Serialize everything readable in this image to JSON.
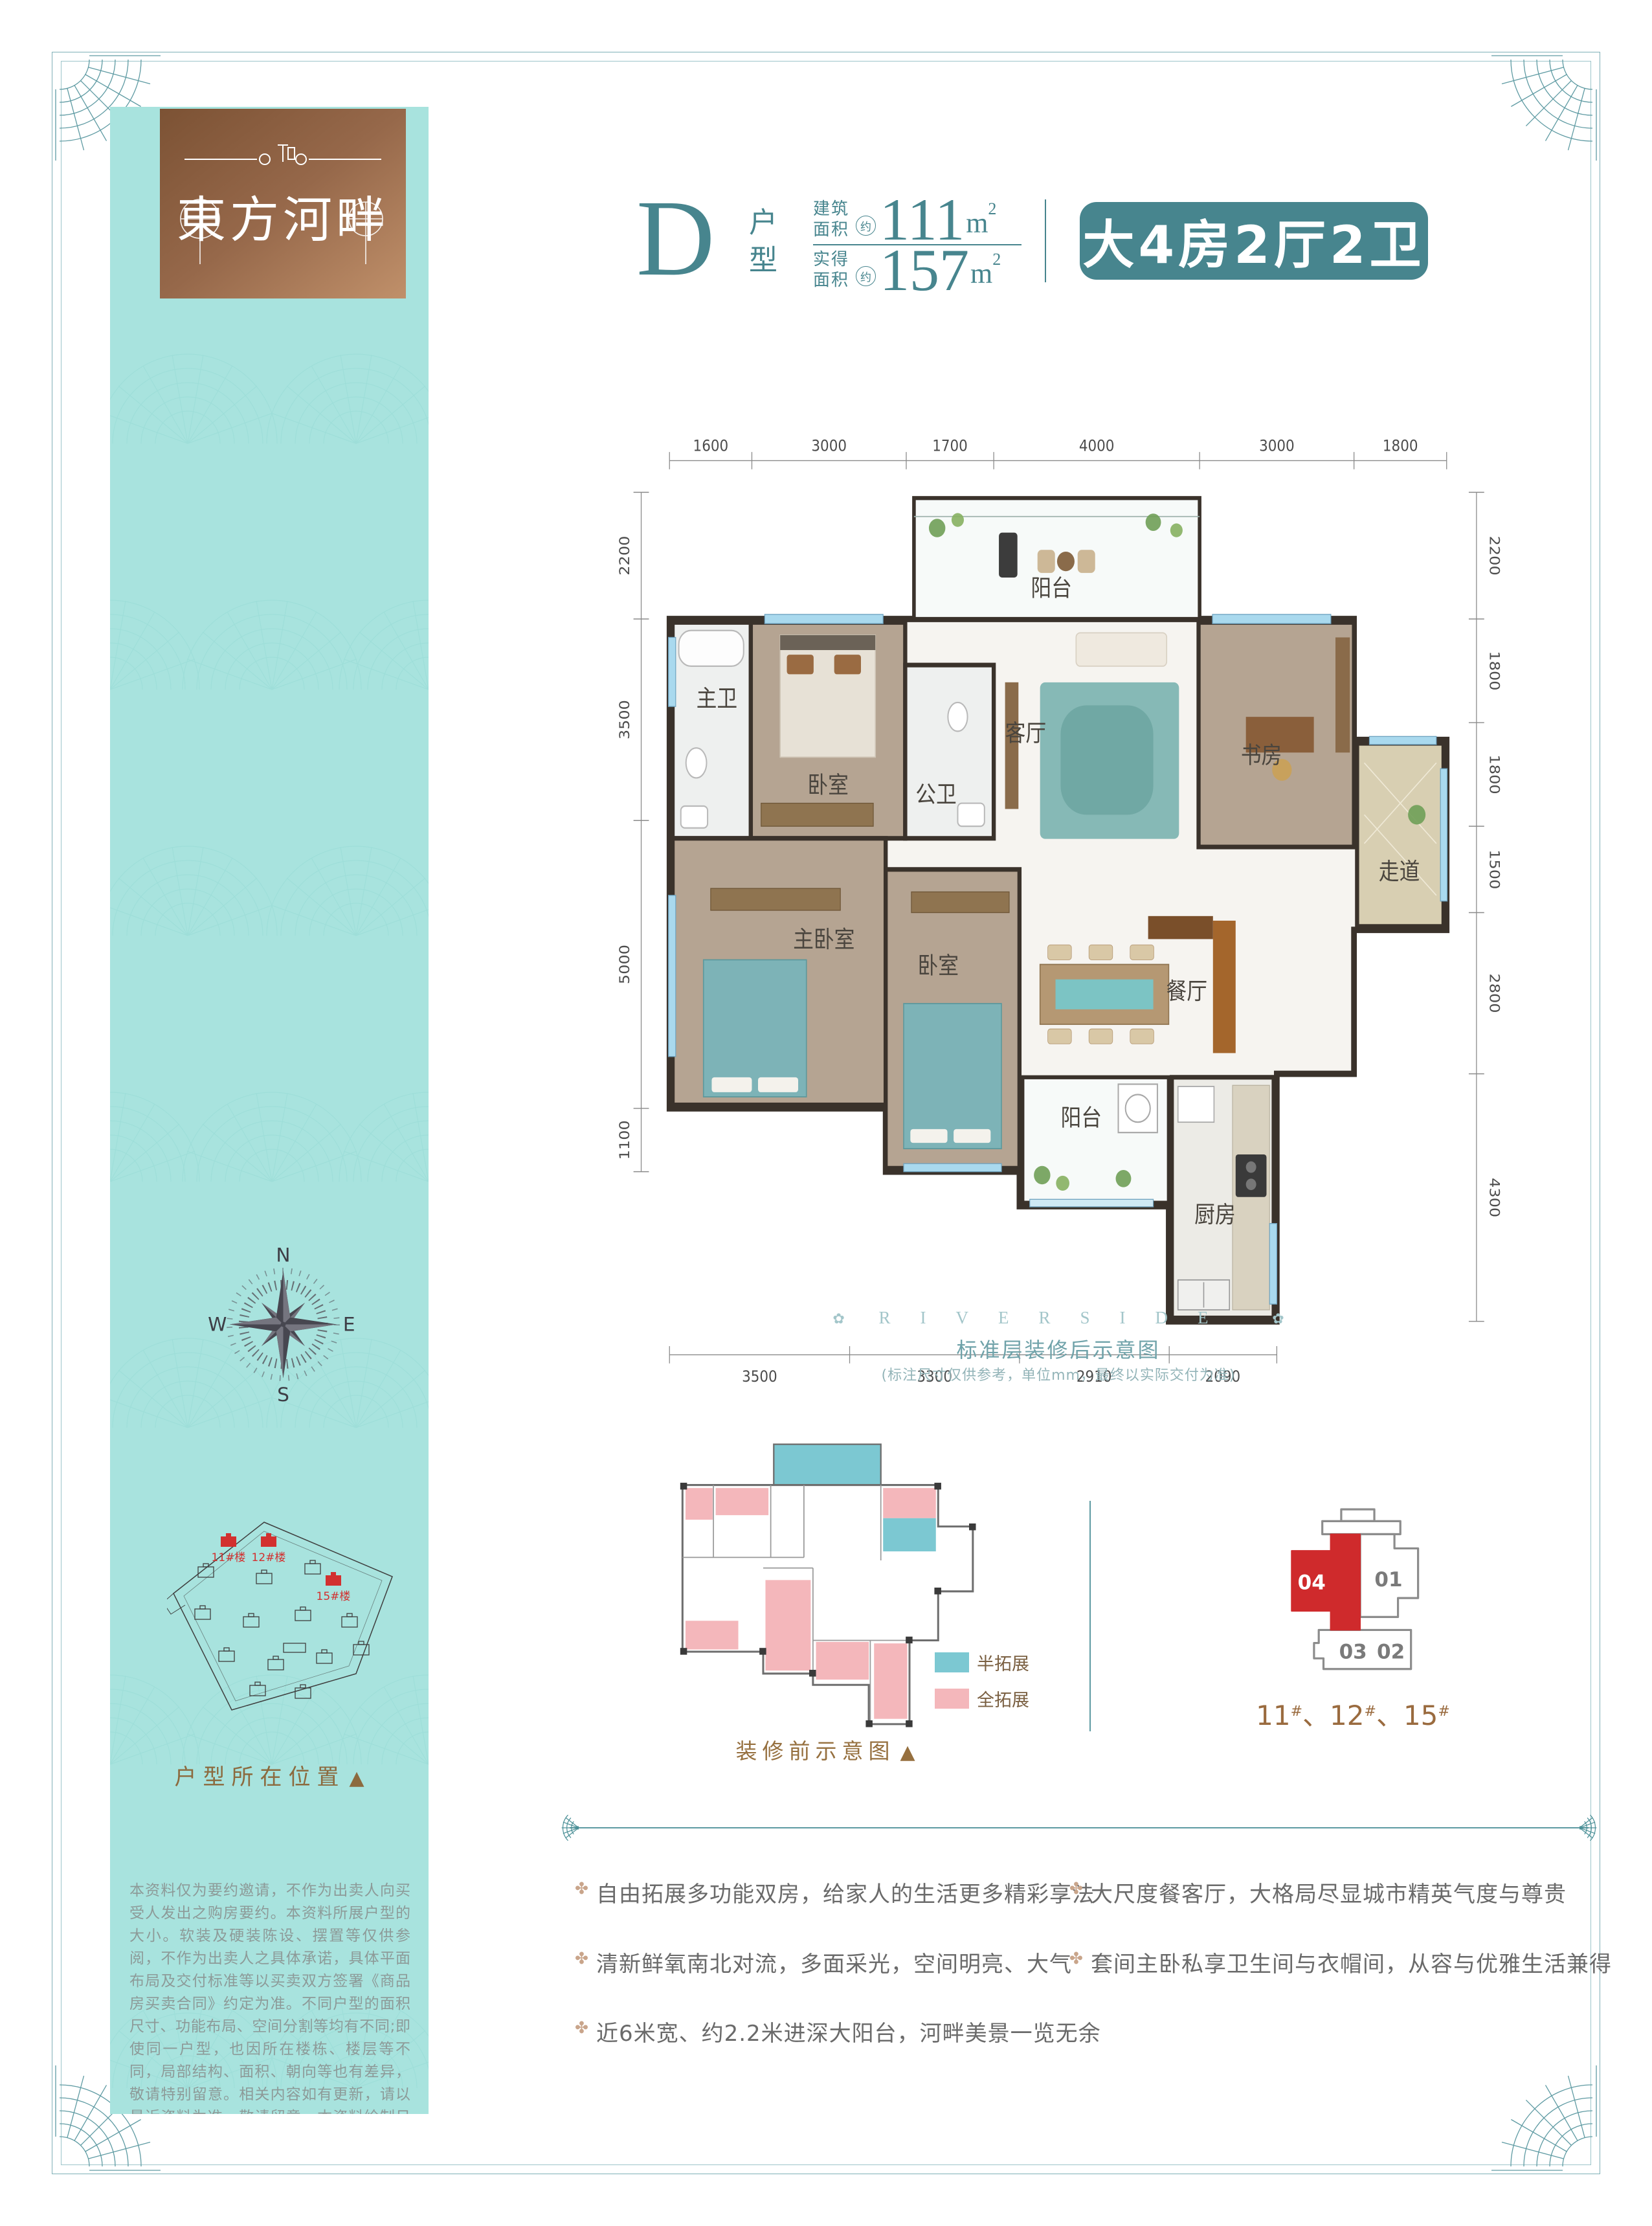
{
  "header": {
    "type_letter": "D",
    "type_label": "户型",
    "areas": [
      {
        "label_top": "建筑",
        "label_bottom": "面积",
        "approx": "约",
        "value": "111",
        "unit": "m",
        "unit_sup": "2"
      },
      {
        "label_top": "实得",
        "label_bottom": "面积",
        "approx": "约",
        "value": "157",
        "unit": "m",
        "unit_sup": "2"
      }
    ],
    "badge": "大4房2厅2卫"
  },
  "plan": {
    "dims": {
      "top": [
        "1600",
        "3000",
        "1700",
        "4000",
        "3000",
        "1800"
      ],
      "left": [
        "2200",
        "3500",
        "5000",
        "1100"
      ],
      "right": [
        "2200",
        "1800",
        "1800",
        "1500",
        "2800",
        "4300"
      ],
      "bottom": [
        "3500",
        "3300",
        "2910",
        "2090"
      ]
    },
    "rooms": {
      "balcony_top": "阳台",
      "master_bath": "主卫",
      "bedroom_top": "卧室",
      "guest_bath": "公卫",
      "living": "客厅",
      "study": "书房",
      "corridor": "走道",
      "master_bedroom": "主卧室",
      "bedroom2": "卧室",
      "dining": "餐厅",
      "balcony_bottom": "阳台",
      "kitchen": "厨房"
    },
    "heading_en": "RIVERSIDE",
    "title": "标准层装修后示意图",
    "note": "(标注尺寸仅供参考，单位mm，最终以实际交付为准)"
  },
  "pre_plan": {
    "caption": "装修前示意图",
    "legend": [
      {
        "label": "半拓展",
        "color": "#7cc8d2"
      },
      {
        "label": "全拓展",
        "color": "#f4b7bb"
      }
    ]
  },
  "key_plan": {
    "units": [
      {
        "id": "04",
        "highlighted": true
      },
      {
        "id": "01",
        "highlighted": false
      },
      {
        "id": "03",
        "highlighted": false
      },
      {
        "id": "02",
        "highlighted": false
      }
    ],
    "buildings": [
      "11",
      "12",
      "15"
    ],
    "hash": "#",
    "separator": "、"
  },
  "features": [
    "自由拓展多功能双房，给家人的生活更多精彩享法",
    "大尺度餐客厅，大格局尽显城市精英气度与尊贵",
    "清新鲜氧南北对流，多面采光，空间明亮、大气",
    "套间主卧私享卫生间与衣帽间，从容与优雅生活兼得",
    "近6米宽、约2.2米进深大阳台，河畔美景一览无余"
  ],
  "sidebar": {
    "logo_name": "東方河畔",
    "compass": {
      "n": "N",
      "e": "E",
      "s": "S",
      "w": "W"
    },
    "site_buildings": [
      "11#楼",
      "12#楼",
      "15#楼"
    ],
    "site_caption": "户型所在位置",
    "legal": "本资料仅为要约邀请，不作为出卖人向买受人发出之购房要约。本资料所展户型的大小。软装及硬装陈设、摆置等仅供参阅，不作为出卖人之具体承诺，具体平面布局及交付标准等以买卖双方签署《商品房买卖合同》约定为准。不同户型的面积尺寸、功能布局、空间分割等均有不同;即使同一户型，也因所在楼栋、楼层等不同，局部结构、面积、朝向等也有差异，敬请特别留意。相关内容如有更新，请以最近资料为准，敬请留意。本资料绘制日期:2022年05月。",
    "developer": "开发商:玉林市华恒房地产有限公司预售证号:玉东房预售证第2021-04号、第2021-14号"
  },
  "glyphs": {
    "triangle": "▲",
    "leaf": "✿",
    "flower": "✤"
  },
  "colors": {
    "accent": "#47858e",
    "sidebar": "#a8e3de",
    "red": "#cf2a2c",
    "legend_teal": "#7cc8d2",
    "legend_pink": "#f4b7bb",
    "brown": "#96703f",
    "bronze": "#8a5c3e"
  }
}
